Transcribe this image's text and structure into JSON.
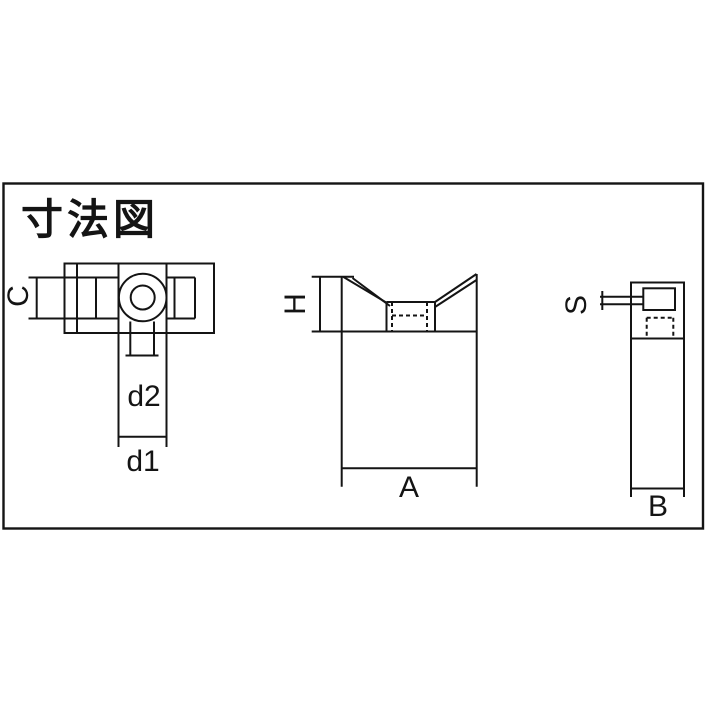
{
  "title": "寸法図",
  "colors": {
    "line": "#141414",
    "background": "#ffffff"
  },
  "dimension_labels": {
    "c": "C",
    "d2": "d2",
    "d1": "d1",
    "h": "H",
    "a": "A",
    "s": "S",
    "b": "B"
  }
}
